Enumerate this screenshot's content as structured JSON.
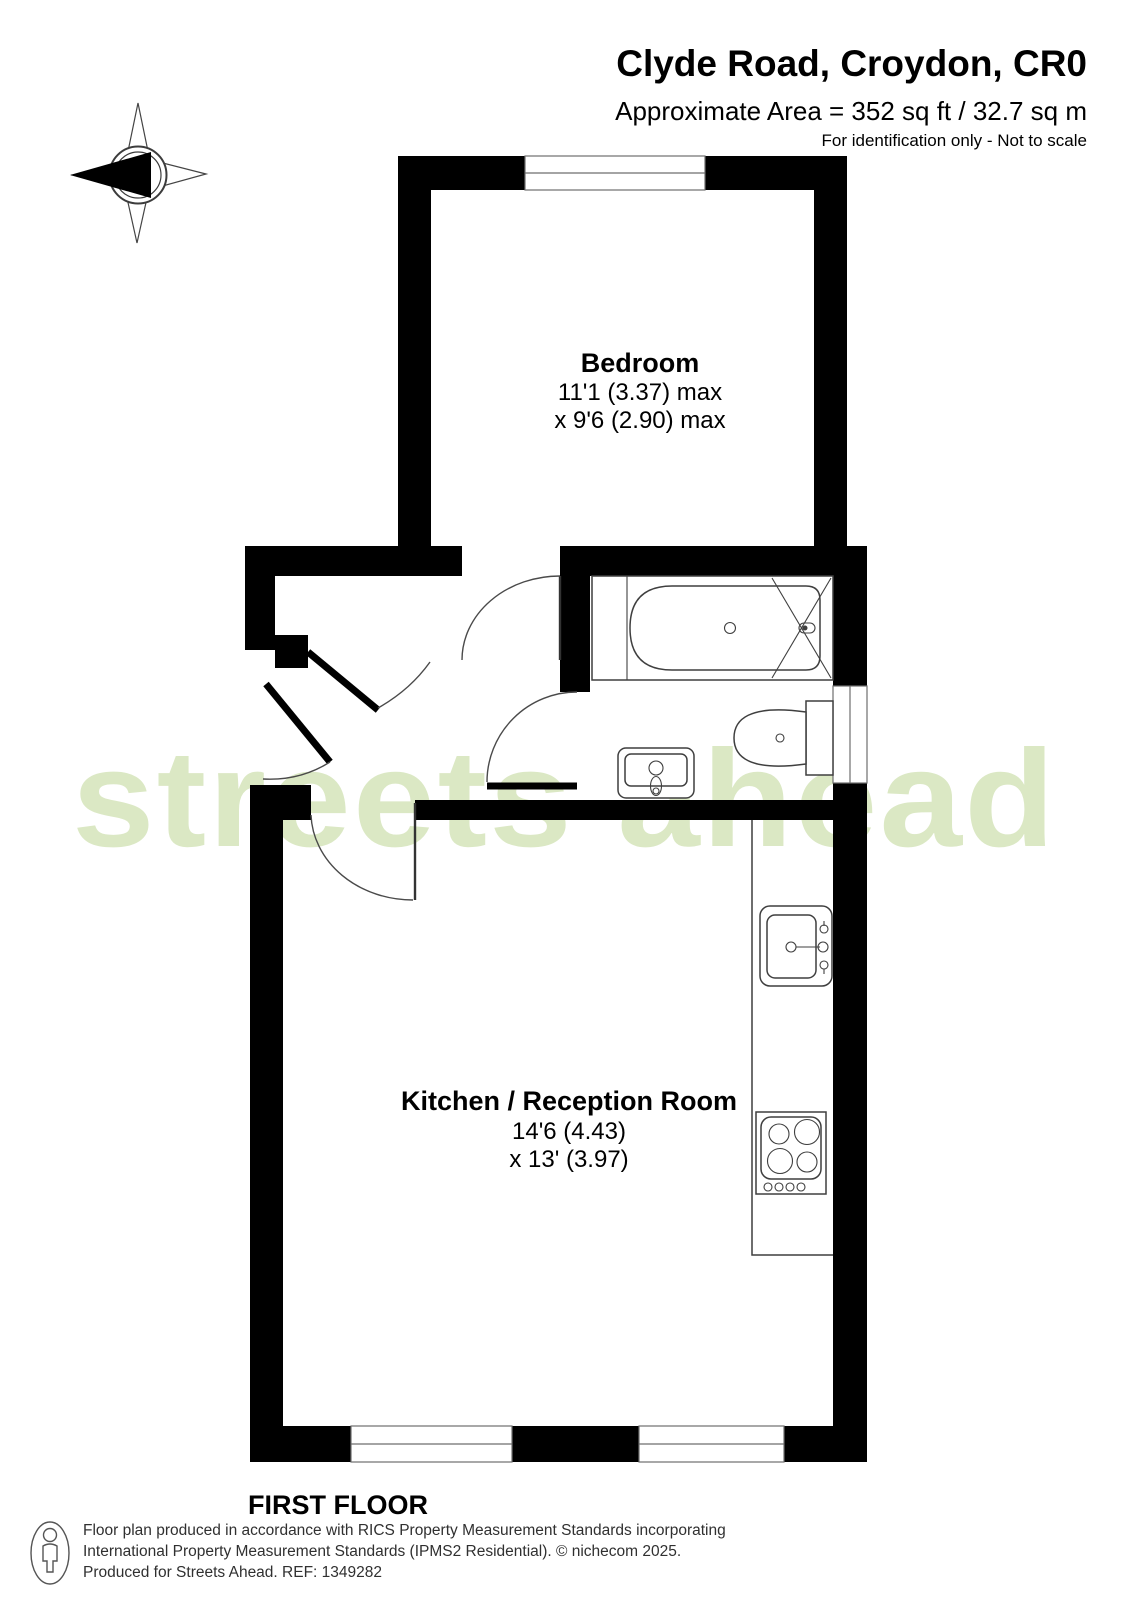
{
  "header": {
    "title": "Clyde Road, Croydon, CR0",
    "area": "Approximate Area = 352 sq ft / 32.7 sq m",
    "disclaimer": "For identification only - Not to scale"
  },
  "compass": {
    "north_label": "N"
  },
  "watermark": {
    "text": "streets ahead",
    "color": "#dbe8c4"
  },
  "plan": {
    "rooms": [
      {
        "name": "Bedroom",
        "dim_line1": "11'1 (3.37) max",
        "dim_line2": "x 9'6 (2.90) max"
      },
      {
        "name": "Kitchen / Reception Room",
        "dim_line1": "14'6 (4.43)",
        "dim_line2": "x 13' (3.97)"
      }
    ],
    "fixtures": [
      "bathtub",
      "shower-over-bath",
      "toilet",
      "basin",
      "kitchen-sink",
      "hob",
      "counter"
    ]
  },
  "floor_label": "FIRST FLOOR",
  "footer": {
    "line1": "Floor plan produced in accordance with RICS Property Measurement Standards incorporating",
    "line2": "International Property Measurement Standards (IPMS2 Residential).   © nichecom 2025.",
    "line3": "Produced for Streets Ahead.   REF:  1349282"
  },
  "colors": {
    "wall": "#000000",
    "watermark": "#dbe8c4"
  }
}
